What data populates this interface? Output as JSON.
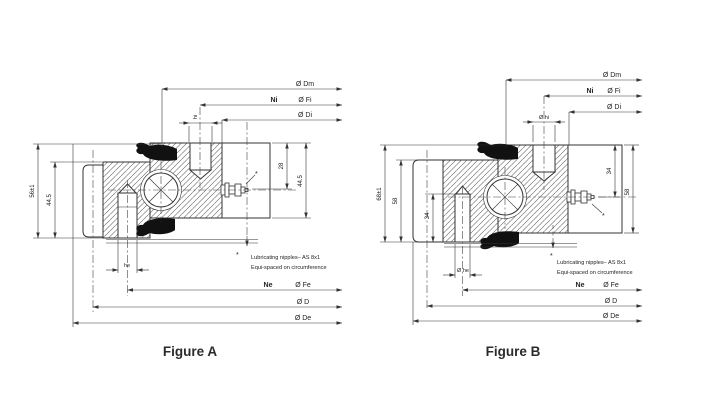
{
  "figure_a": {
    "caption": "Figure A",
    "dims": {
      "dm": "Ø Dm",
      "ni": "Ni",
      "fi": "Ø Fi",
      "di": "Ø Di",
      "hi": "hi",
      "height_total": "56±1",
      "height_outer": "44.5",
      "nipple_offset": "28",
      "height_inner": "44.5",
      "he": "he",
      "ne": "Ne",
      "fe": "Ø Fe",
      "d": "Ø D",
      "de": "Ø De"
    },
    "nipple_star": "*",
    "note": {
      "marker": "*",
      "line1": "Lubricating nipples– AS 8x1",
      "line2": "Equi-spaced on circumference"
    }
  },
  "figure_b": {
    "caption": "Figure B",
    "dims": {
      "dm": "Ø Dm",
      "ni": "Ni",
      "fi": "Ø Fi",
      "di": "Ø Di",
      "hi": "Ø hi",
      "height_total": "68±1",
      "height_outer": "58",
      "hole_depth": "34",
      "nipple_offset": "34",
      "height_inner": "58",
      "he": "Ø he",
      "ne": "Ne",
      "fe": "Ø Fe",
      "d": "Ø D",
      "de": "Ø De"
    },
    "nipple_star": "*",
    "note": {
      "marker": "*",
      "line1": "Lubricating nipples– AS 8x1",
      "line2": "Equi-spaced on circumference"
    }
  },
  "colors": {
    "line": "#333333",
    "background": "#ffffff"
  }
}
